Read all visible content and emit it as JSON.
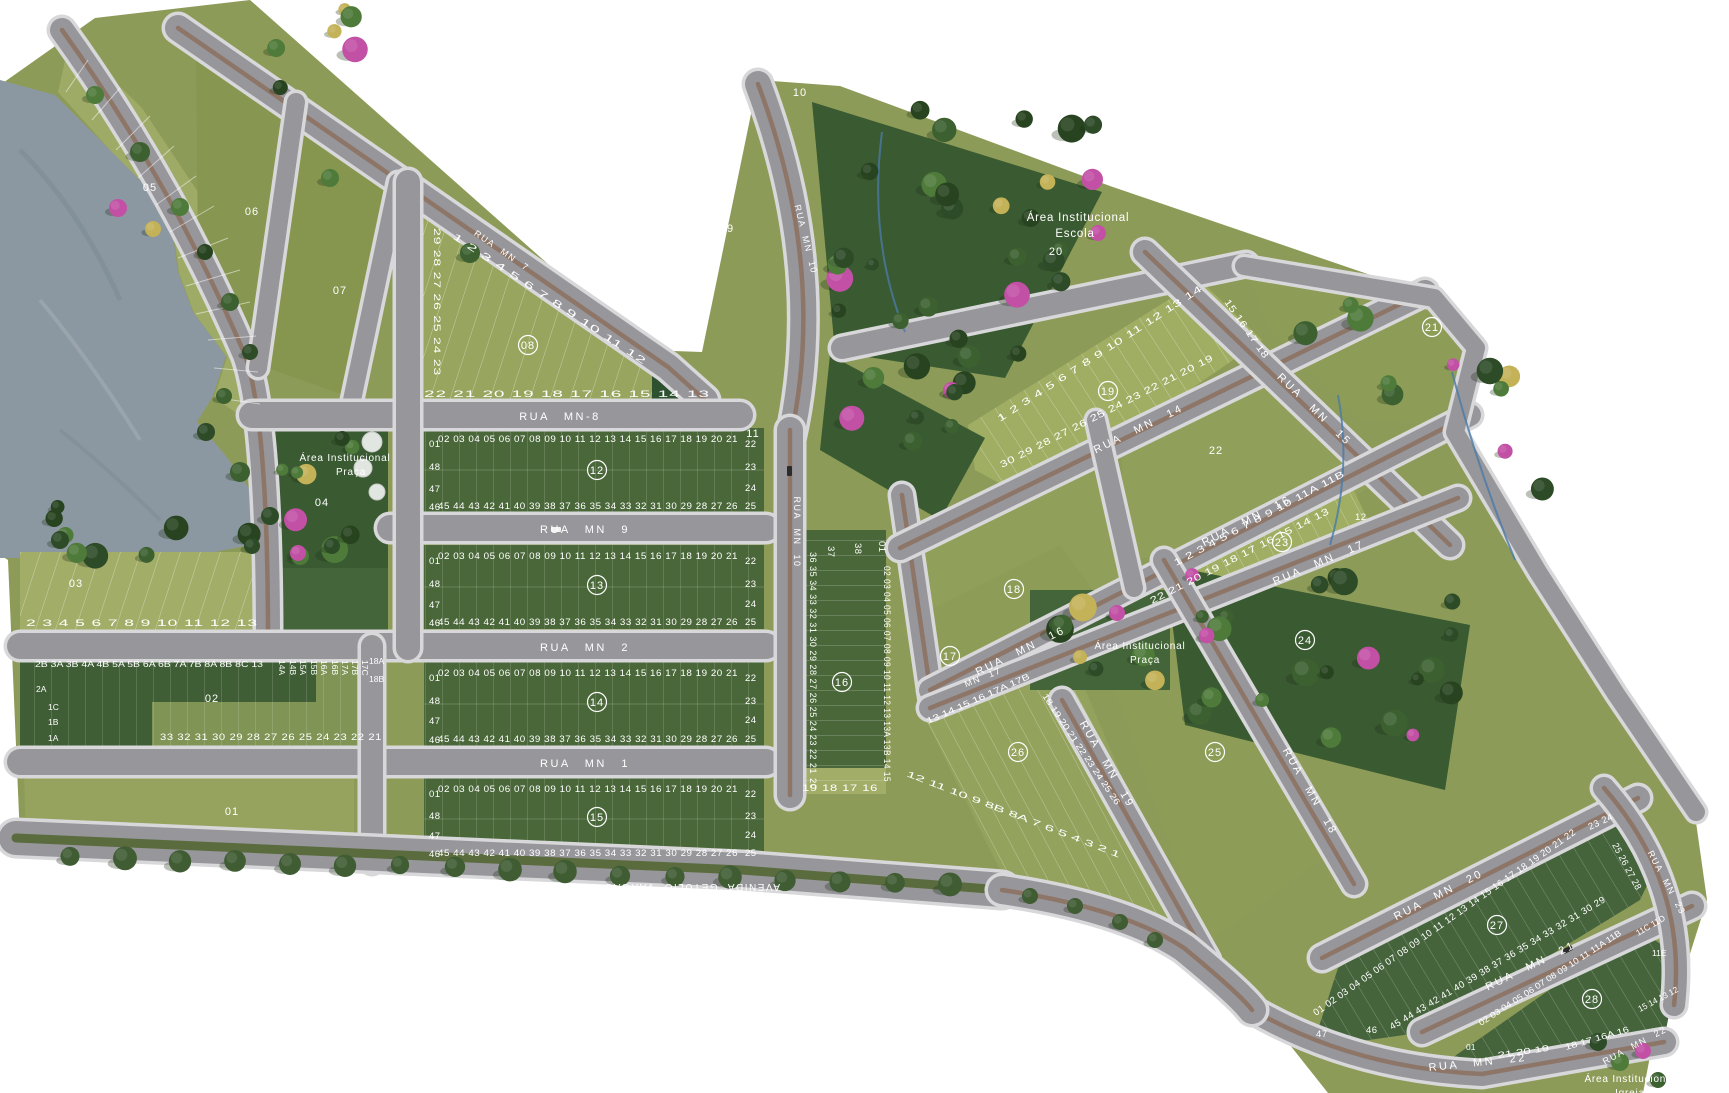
{
  "streets": {
    "mn7": "RUA MN 7",
    "mn8": "RUA MN-8",
    "mn9": "RUA MN 9",
    "mn2": "RUA MN 2",
    "mn1": "RUA MN 1",
    "mn10": "RUA MN 10",
    "mn14": "RUA MN 14",
    "mn15": "RUA MN 15",
    "mn16": "RUA MN 16",
    "mn17": "RUA MN 17",
    "mn17_short": "MN 17",
    "mn18": "RUA MN 18",
    "mn19": "RUA MN 19",
    "mn20": "RUA MN 20",
    "mn21": "RUA MN 21",
    "mn22": "RUA MN 22",
    "mn23": "RUA MN 23",
    "avenida": "AVENIDA GETULIO VARGAS",
    "avenida_frag1": "AVEN",
    "avenida_frag2": "GETULIO VARGA"
  },
  "areas": {
    "institutional": "Área Institucional",
    "escola": "Escola",
    "praca": "Praça",
    "igreja": "Igreja"
  },
  "blocks": {
    "b01": {
      "label": "01"
    },
    "b02": {
      "label": "02",
      "top": "2B 3A 3B 4A 4B 5A 5B 6A 6B 7A 7B 8A 8B 8C 13",
      "v0": "14A",
      "v1": "14B",
      "v2": "15A",
      "v3": "15B",
      "v4": "16A",
      "v5": "16B",
      "v6": "17A",
      "v7": "17B",
      "v8": "17C",
      "r0": "18A",
      "r1": "18B",
      "l0": "2A",
      "l1": "1C",
      "l2": "1B",
      "l3": "1A",
      "bottom": "33 32 31 30 29 28 27 26 25 24 23 22 21"
    },
    "b03": {
      "label": "03",
      "row": "2 3 4 5 6 7 8 9 10 11 12 13"
    },
    "b04": {
      "label": "04"
    },
    "b05": {
      "label": "05"
    },
    "b06": {
      "label": "06"
    },
    "b07": {
      "label": "07"
    },
    "b08": {
      "label": "08",
      "top": "1 2 3 4 5 6 7 8 9 10 11 12",
      "left": "29 28 27 26 25 24 23",
      "bottom": "22 21 20 19 18 17 16 15 14 13"
    },
    "b09": {
      "label": "09"
    },
    "b10": {
      "label": "10"
    },
    "b11": {
      "label": "11"
    },
    "b12": {
      "label": "12",
      "top": "02 03 04 05 06 07 08 09 10 11 12 13 14 15 16 17 18 19 20 21",
      "bottom": "45 44 43 42 41 40 39 38 37 36 35 34 33 32 31 30 29 28 27 26",
      "l0": "01",
      "l1": "48",
      "l2": "47",
      "l3": "46",
      "r0": "22",
      "r1": "23",
      "r2": "24",
      "r3": "25"
    },
    "b13": {
      "label": "13",
      "top": "02 03 04 05 06 07 08 09 10 11 12 13 14 15 16 17 18 19 20 21",
      "bottom": "45 44 43 42 41 40 39 38 37 36 35 34 33 32 31 30 29 28 27 26",
      "l0": "01",
      "l1": "48",
      "l2": "47",
      "l3": "46",
      "r0": "22",
      "r1": "23",
      "r2": "24",
      "r3": "25"
    },
    "b14": {
      "label": "14",
      "top": "02 03 04 05 06 07 08 09 10 11 12 13 14 15 16 17 18 19 20 21",
      "bottom": "45 44 43 42 41 40 39 38 37 36 35 34 33 32 31 30 29 28 27 26",
      "l0": "01",
      "l1": "48",
      "l2": "47",
      "l3": "46",
      "r0": "22",
      "r1": "23",
      "r2": "24",
      "r3": "25"
    },
    "b15": {
      "label": "15",
      "top": "02 03 04 05 06 07 08 09 10 11 12 13 14 15 16 17 18 19 20 21",
      "bottom": "45 44 43 42 41 40 39 38 37 36 35 34 33 32 31 30 29 28 27 26",
      "l0": "01",
      "l1": "48",
      "l2": "47",
      "l3": "46",
      "r0": "22",
      "r1": "23",
      "r2": "24",
      "r3": "25"
    },
    "b16": {
      "label": "16",
      "left": "36 35 34 33 32 31 30 29 28 27 26 25 24 23 22 21",
      "corner": "20",
      "t0": "37",
      "t1": "38",
      "t2": "01",
      "right": "02 03 04 05 06 07 08 09 10 11 12 13 13A 13B 14 15",
      "bottom": "19 18 17 16"
    },
    "b17": {
      "label": "17"
    },
    "b18": {
      "label": "18"
    },
    "b19": {
      "label": "19",
      "top": "1 2 3 4 5 6 7 8 9 10 11 12 13 14",
      "right": "15 16 17 18",
      "bottom": "30 29 28 27 26 25 24 23 22 21 20 19"
    },
    "b20": {
      "label": "20"
    },
    "b21": {
      "label": "21"
    },
    "b22": {
      "label": "22"
    },
    "b23": {
      "label": "23",
      "top": "1 2 3 4 5 6 7 8 9 10 11A 11B",
      "right": "12",
      "bottom": "22 21 20 19 18 17 16 15 14 13"
    },
    "b24": {
      "label": "24"
    },
    "b25": {
      "label": "25"
    },
    "b26": {
      "label": "26",
      "top": "13 14 15 16 17A 17B",
      "right": "18 19 20 21 22 23 24 25 26",
      "bottom": "12 11 10 9 8B 8A 7 6 5 4 3 2 1"
    },
    "b27": {
      "label": "27",
      "top": "01 02 03 04 05 06 07 08 09 10 11 12 13 14 15 16 17 18 19 20 21 22",
      "corner": "23 24",
      "right": "25 26 27 28",
      "bottom": "45 44 43 42 41 40 39 38 37 36 35 34 33 32 31 30 29",
      "l0": "47",
      "l1": "46"
    },
    "b28": {
      "label": "28",
      "top": "02 03 04 05 06 07 08 09 10 11 11A 11B",
      "corner": "11C 11D",
      "corner2": "11E",
      "right": "15 14 13 12",
      "lower": "18 17 16A 16",
      "bottom": "21 20 19",
      "l0": "01"
    },
    "colors": {
      "land": "#8d9b58",
      "dark_lot": "#4a6739",
      "light_lot": "#a2ad68",
      "forest": "#3a5a31",
      "water": "#8c98a1",
      "road": "#97969b",
      "sidewalk": "#d8d8da",
      "median": "#8c7262",
      "flower_pink": "#c251a5",
      "flower_yellow": "#c3b257"
    }
  }
}
